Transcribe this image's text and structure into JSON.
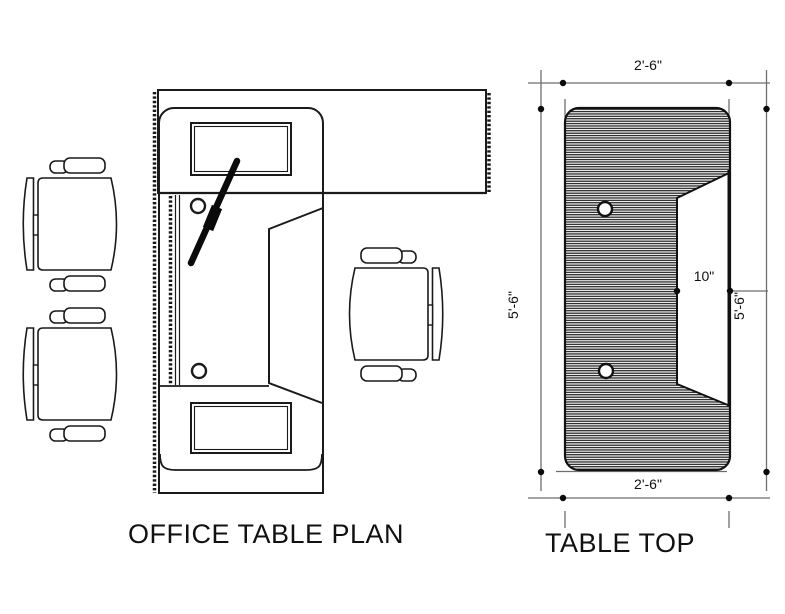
{
  "page": {
    "background": "#ffffff",
    "line_color": "#1a1a1a",
    "dim_line_color": "#6e6e6e"
  },
  "plan": {
    "title": "OFFICE TABLE PLAN"
  },
  "tabletop": {
    "title": "TABLE TOP",
    "dims": {
      "width_top": "2'-6\"",
      "width_bottom": "2'-6\"",
      "height_left": "5'-6\"",
      "height_right": "5'-6\"",
      "tray_depth": "10\""
    }
  }
}
